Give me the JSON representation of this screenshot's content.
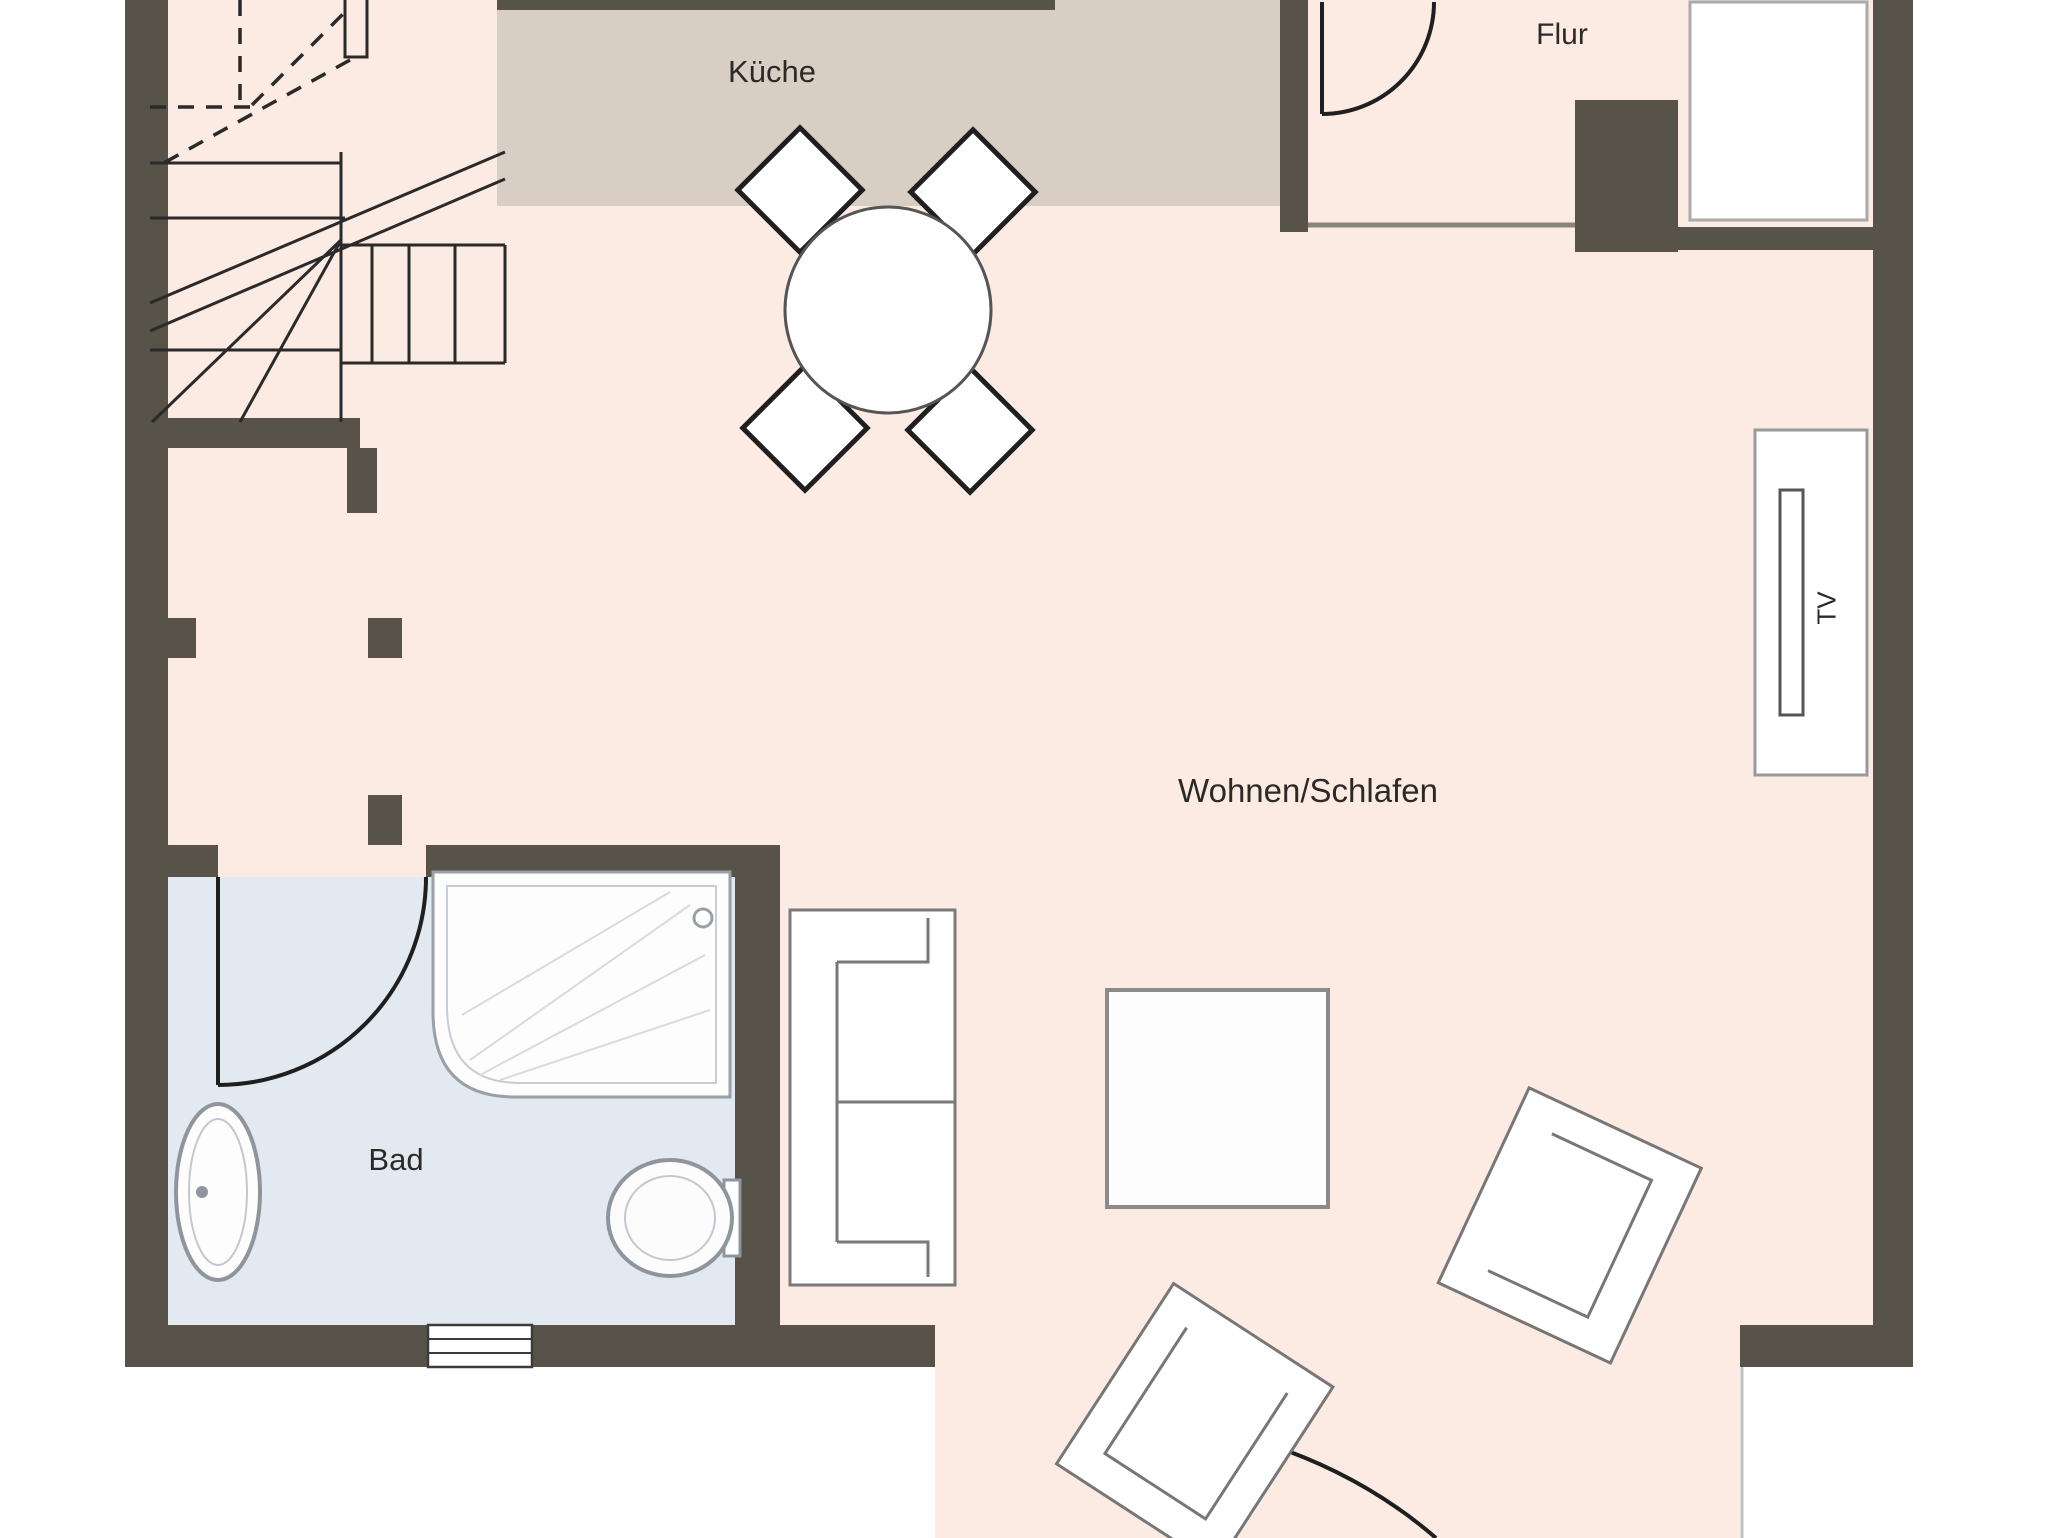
{
  "rooms": {
    "kitchen": {
      "label": "Küche",
      "floor_color": "#d9cec4"
    },
    "hallway": {
      "label": "Flur",
      "floor_color": "#fcebe3"
    },
    "living": {
      "label": "Wohnen/Schlafen",
      "floor_color": "#fcebe3"
    },
    "bathroom": {
      "label": "Bad",
      "floor_color": "#e3e9f1"
    }
  },
  "furniture": {
    "tv_label": "TV"
  },
  "colors": {
    "wall": "#575349",
    "outline": "#1f1f1f",
    "stair_line": "#2a2a2a",
    "floor_main": "#fcebe3",
    "floor_kitchen": "#d9cec4",
    "floor_bath": "#e3e9f1",
    "fixture_stroke": "#8f959c",
    "furniture_stroke": "#7a7a7a"
  }
}
